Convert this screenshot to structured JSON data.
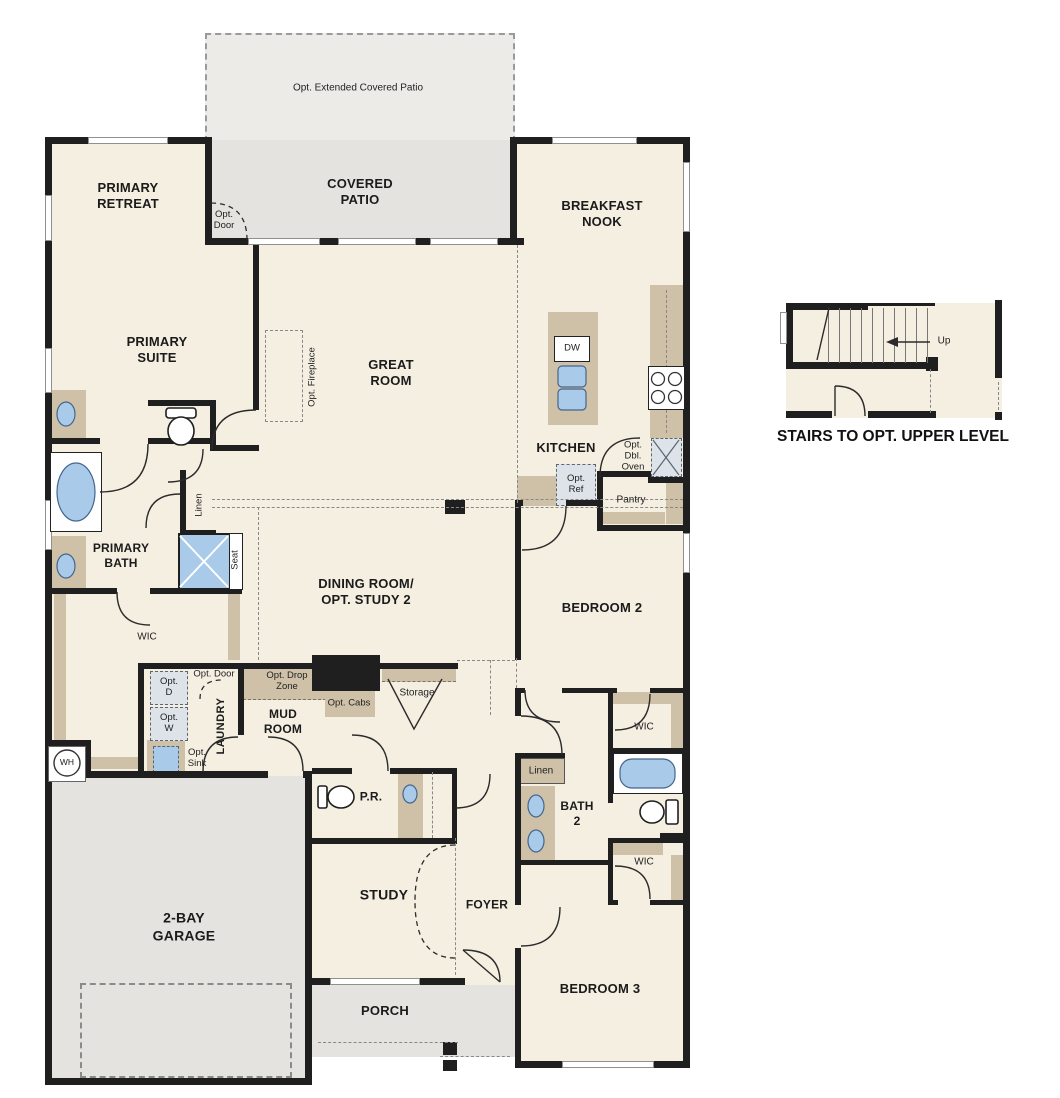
{
  "labels": {
    "optExtPatio": "Opt. Extended Covered Patio",
    "coveredPatio": "COVERED\nPATIO",
    "optDoorPatio": "Opt.\nDoor",
    "primaryRetreat": "PRIMARY\nRETREAT",
    "breakfastNook": "BREAKFAST\nNOOK",
    "primarySuite": "PRIMARY\nSUITE",
    "optFireplace": "Opt. Fireplace",
    "greatRoom": "GREAT\nROOM",
    "dw": "DW",
    "kitchen": "KITCHEN",
    "optDblOven": "Opt.\nDbl.\nOven",
    "optRef": "Opt.\nRef",
    "pantry": "Pantry",
    "linen": "Linen",
    "seat": "Seat",
    "primaryBath": "PRIMARY\nBATH",
    "dining": "DINING ROOM/\nOPT. STUDY 2",
    "bedroom2": "BEDROOM 2",
    "wic": "WIC",
    "optDoorLaundry": "Opt. Door",
    "optDropZone": "Opt. Drop\nZone",
    "optD": "Opt.\nD",
    "optW": "Opt.\nW",
    "laundry": "LAUNDRY",
    "mudRoom": "MUD\nROOM",
    "optCabs": "Opt. Cabs",
    "storage": "Storage",
    "optSink": "Opt.\nSink",
    "wh": "WH",
    "pr": "P.R.",
    "bath2": "BATH\n2",
    "garage": "2-BAY\nGARAGE",
    "study": "STUDY",
    "foyer": "FOYER",
    "bedroom3": "BEDROOM 3",
    "porch": "PORCH",
    "up": "Up",
    "stairsCaption": "STAIRS TO OPT. UPPER LEVEL"
  },
  "colors": {
    "wall": "#1f1f1f",
    "floor": "#f5efe2",
    "patio": "#e4e3e0",
    "counter": "#cec1a7",
    "fixtureBlue": "#a9cae8",
    "applianceGray": "#dde3e9"
  }
}
